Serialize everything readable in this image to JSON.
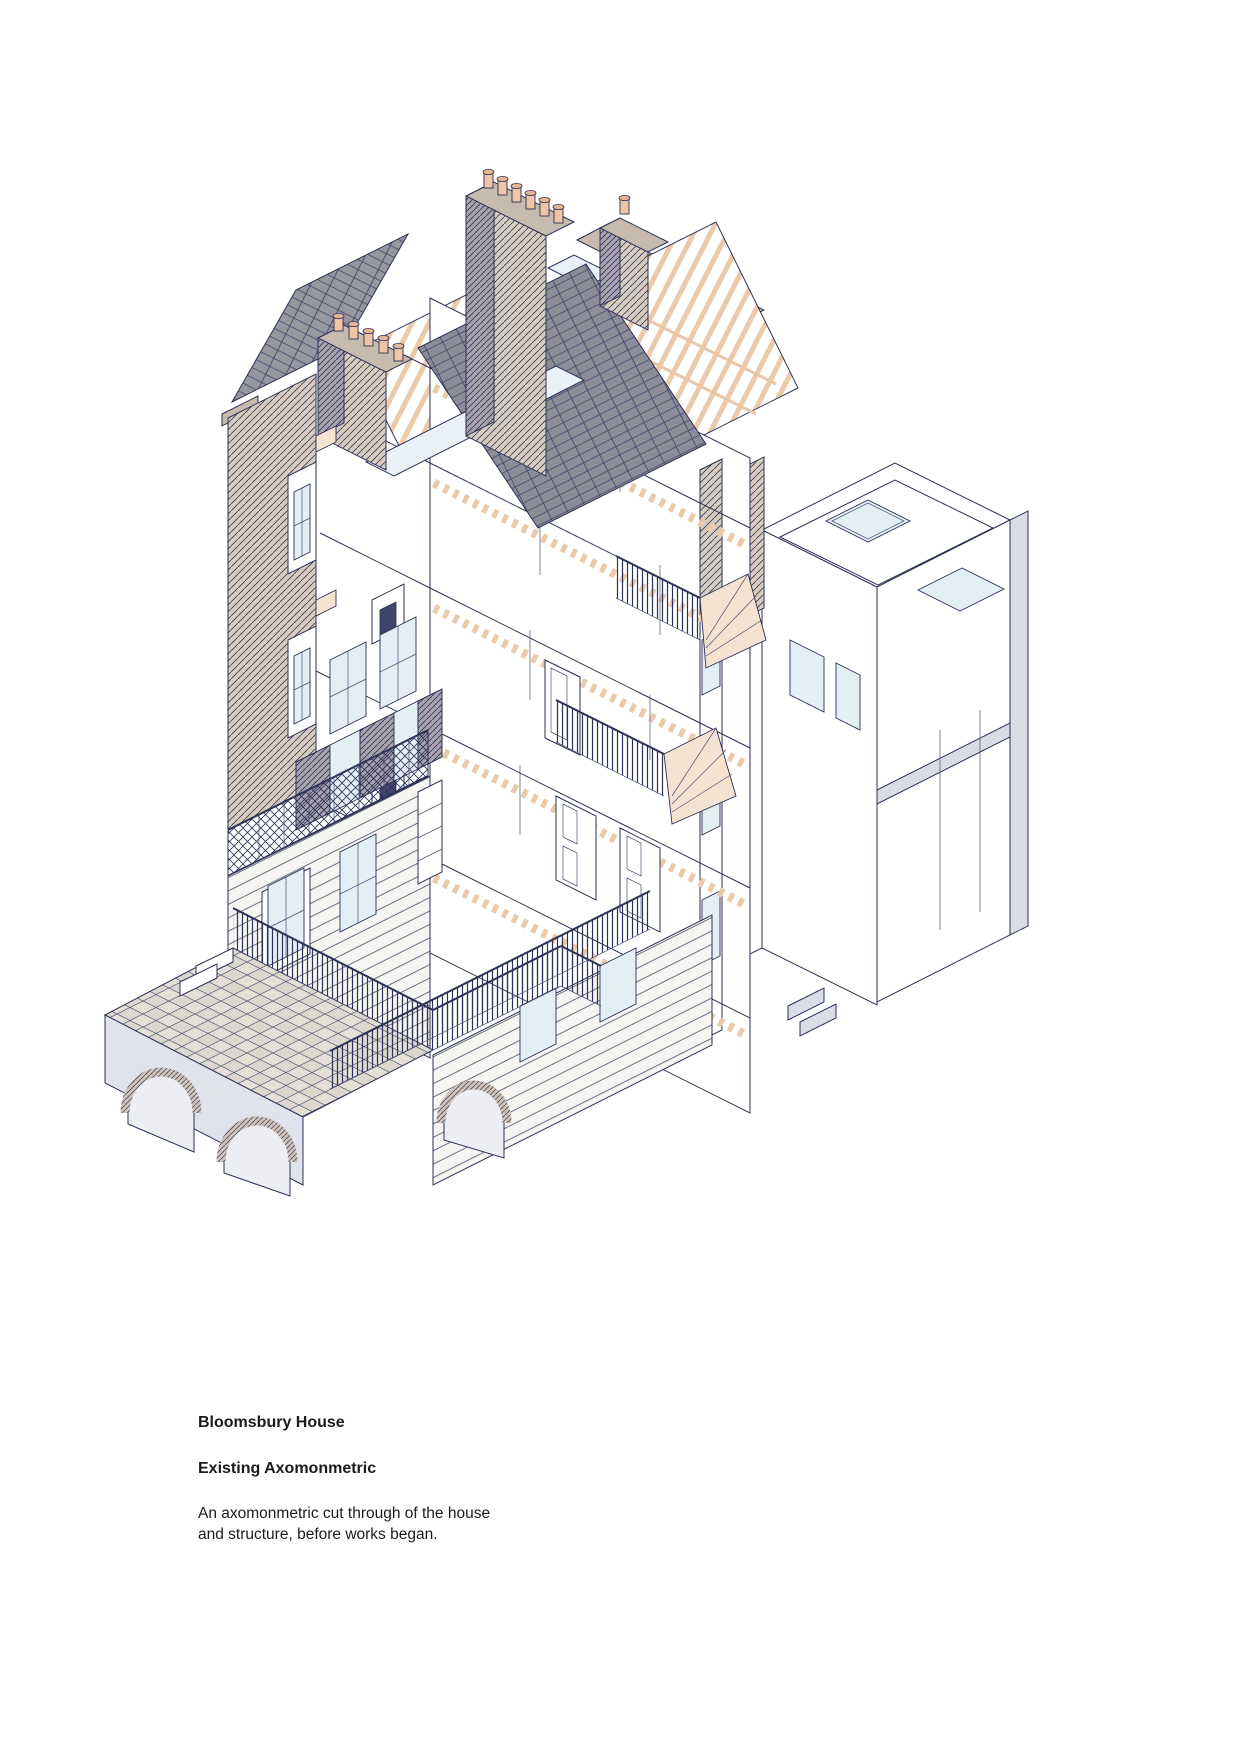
{
  "page": {
    "background_color": "#ffffff"
  },
  "caption": {
    "title": "Bloomsbury House",
    "subtitle": "Existing Axomonmetric",
    "description": "An axomonmetric cut through of the house and structure, before works began."
  },
  "drawing": {
    "label": "Axonometric cut-through drawing of Bloomsbury House showing slate roofs with exposed timber rafters, chimney stacks with pots, four floors of timber joists and floorboards, staircases, cut brick front wall, balcony with lattice railing, rusticated stone base, railed pavement over brick vaults, and a flat-roofed rear extension with skylights",
    "palette": {
      "line": "#2c3156",
      "slate_roof": "#8d8d99",
      "cut_brick_hatch": "#d7ccbd",
      "timber_floor": "#f6e2d0",
      "chimney_pot": "#efc5a5",
      "lead_flat_roof": "#eaf0f8",
      "glass": "#e3eef5",
      "stone_coping": "#c6bbad",
      "extension_wall": "#d9dce5",
      "paving": "#ddd8cf"
    }
  }
}
